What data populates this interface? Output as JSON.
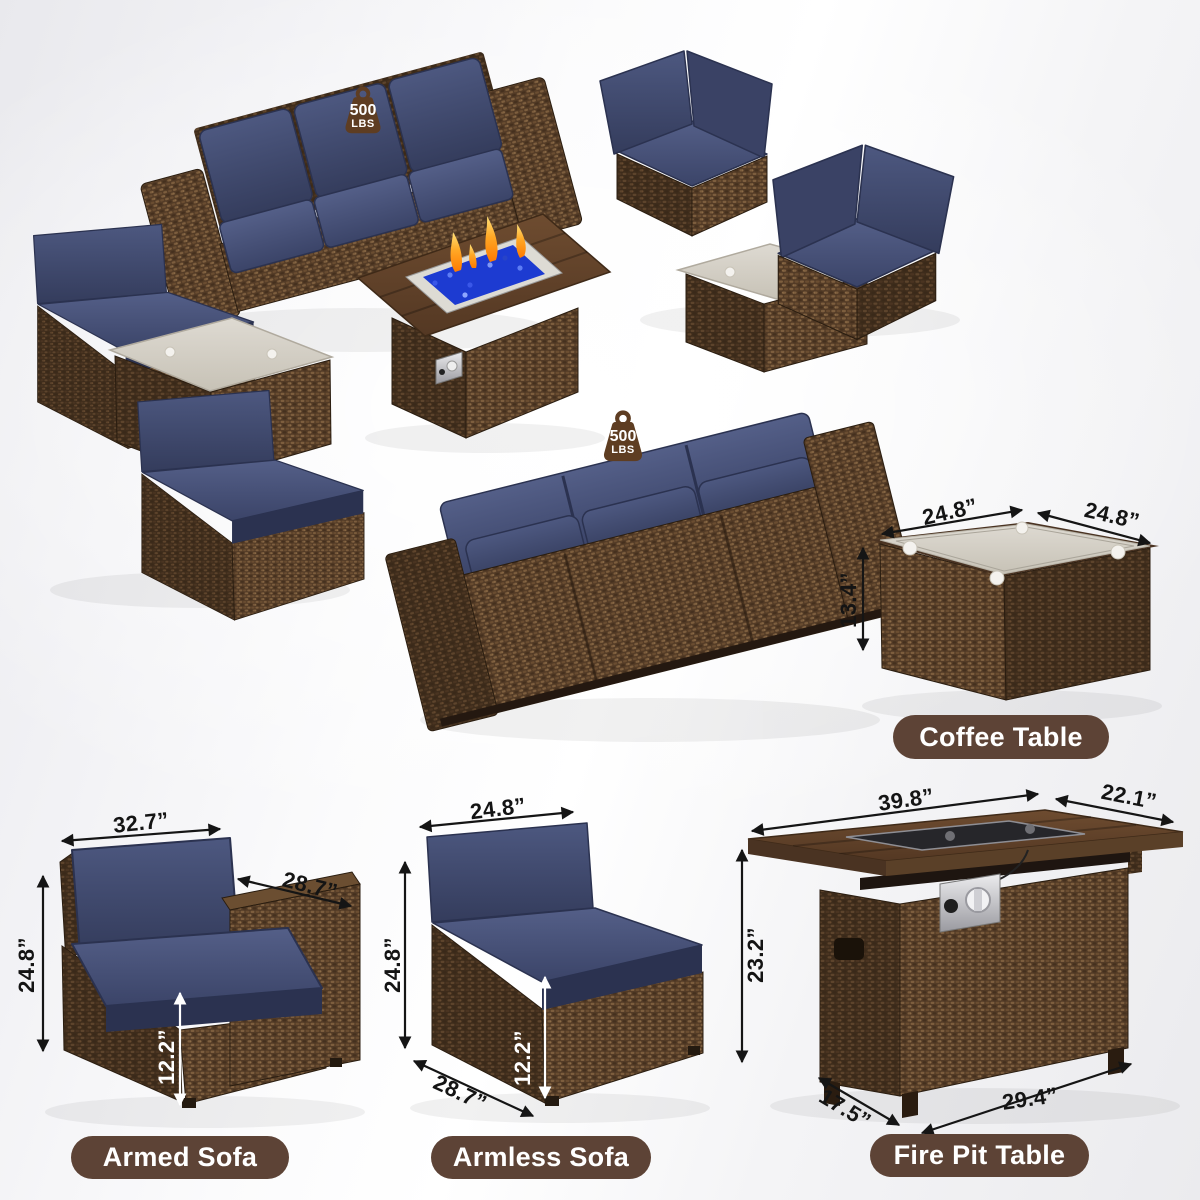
{
  "badge": {
    "value": "500",
    "unit": "LBS"
  },
  "coffee_table": {
    "label": "Coffee Table",
    "top_width": "24.8”",
    "top_depth": "24.8”",
    "height": "13.4”"
  },
  "armed_sofa": {
    "label": "Armed Sofa",
    "width": "32.7”",
    "depth": "28.7”",
    "height": "24.8”",
    "seat_height": "12.2”"
  },
  "armless_sofa": {
    "label": "Armless Sofa",
    "width": "24.8”",
    "height": "24.8”",
    "seat_height": "12.2”",
    "depth": "28.7”"
  },
  "fire_pit": {
    "label": "Fire Pit Table",
    "top_length": "39.8”",
    "top_depth": "22.1”",
    "height": "23.2”",
    "base_depth": "17.5”",
    "base_length": "29.4”"
  },
  "colors": {
    "navy_cushion": "#3d4667",
    "rattan_brown": "#5a4129",
    "label_pill": "#5d4336",
    "badge": "#5e3d22",
    "dimension_text": "#141414",
    "fire_glass_blue": "#1d3bd1",
    "flame_orange": "#ff9d2e"
  }
}
